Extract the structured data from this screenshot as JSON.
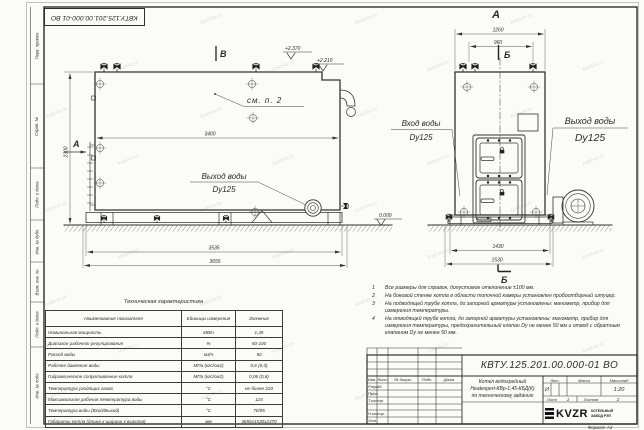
{
  "sheet": {
    "doc_number": "КВТУ.125.201.00.000-01 ВО",
    "format_label": "Формат  А3",
    "watermark": "kotel-kv.ru"
  },
  "margin_labels": [
    "Перв. примен.",
    "Справ. №",
    "Подп. и дата",
    "Инв. № дубл.",
    "Взам. инв. №",
    "Подп. и дата",
    "Инв. № подл."
  ],
  "drawing": {
    "side": {
      "mark_v": "В",
      "see_note": "см. п. 2",
      "dim_inner": "3400",
      "dim_height": "2300",
      "dim_supports": "3535",
      "dim_overall": "3655",
      "elev1": "+2.370",
      "elev2": "+2.210",
      "elev_zero": "0.000",
      "view_arrow_label": "А",
      "outlet_line1": "Выход воды",
      "outlet_line2": "Dy125"
    },
    "front": {
      "view_label": "А",
      "section_top": "Б",
      "section_bottom": "Б",
      "dim_overall": "1260",
      "dim_valves": "960",
      "dim_supports": "1430",
      "dim_base": "1530",
      "inlet_line1": "Вход воды",
      "inlet_line2": "Dy125",
      "outlet_line1": "Выход воды",
      "outlet_line2": "Dy125"
    }
  },
  "notes": [
    {
      "num": "1",
      "text": "Все размеры для справок, допустимое отклонение ±100 мм."
    },
    {
      "num": "2",
      "text": "На боковой стенке котла в области топочной камеры установлен пробоотборный штуцер."
    },
    {
      "num": "3",
      "text": "На подводящей трубе котла, до запорной арматуры установлены: манометр, прибор для измерения температуры."
    },
    {
      "num": "4",
      "text": "На отводящей трубе котла, до запорной арматуры установлены: манометр, прибор для измерения температуры, предохранительный клапан Dу не менее 50 мм и отвод с обратным клапаном Dу не менее 50 мм."
    }
  ],
  "tech_table": {
    "title": "Техническая характеристика",
    "headers": {
      "name": "Наименование показателя",
      "units": "Единицы измерения",
      "value": "Значение"
    },
    "rows": [
      {
        "name": "Номинальная мощность",
        "units": "МВт",
        "value": "1,45"
      },
      {
        "name": "Диапазон рабочего регулирования",
        "units": "%",
        "value": "50-100"
      },
      {
        "name": "Расход воды",
        "units": "м3/ч",
        "value": "50"
      },
      {
        "name": "Рабочее давление воды",
        "units": "МПа (кгс/см2)",
        "value": "0,6 (6,0)"
      },
      {
        "name": "Гидравлическое сопротивление котла",
        "units": "МПа (кгс/см2)",
        "value": "0,06 (0,6)"
      },
      {
        "name": "Температура уходящих газов",
        "units": "°С",
        "value": "не более 220"
      },
      {
        "name": "Максимальная рабочая температура воды",
        "units": "°С",
        "value": "115"
      },
      {
        "name": "Температура воды (Вход/Выход)",
        "units": "°С",
        "value": "70/95"
      },
      {
        "name": "Габариты котла (длина х ширина х высота)",
        "units": "мм",
        "value": "3655х1530х2370"
      }
    ]
  },
  "title_block": {
    "doc_number": "КВТУ.125.201.00.000-01  ВО",
    "product_name": [
      "Котел водогрейный",
      "Heatexpert-КВр-1,45-КБД(К)",
      "по техническому заданию"
    ],
    "columns": [
      "Изм.",
      "Лист",
      "№ докум.",
      "Подп.",
      "Дата"
    ],
    "roles": [
      "Разраб.",
      "Пров.",
      "Т.контр.",
      "Н.контр.",
      "Утв."
    ],
    "lit_label": "Лит.",
    "lit_value": "И",
    "mass_label": "Масса",
    "scale_label": "Масштаб",
    "scale_value": "1:20",
    "sheet_label": "Лист",
    "sheet_number": "1",
    "sheets_label": "Листов",
    "sheets_total": "2",
    "logo_text": "KVZR",
    "company": [
      "КОТЕЛЬНЫЙ",
      "ЗАВОД РЭП"
    ]
  }
}
